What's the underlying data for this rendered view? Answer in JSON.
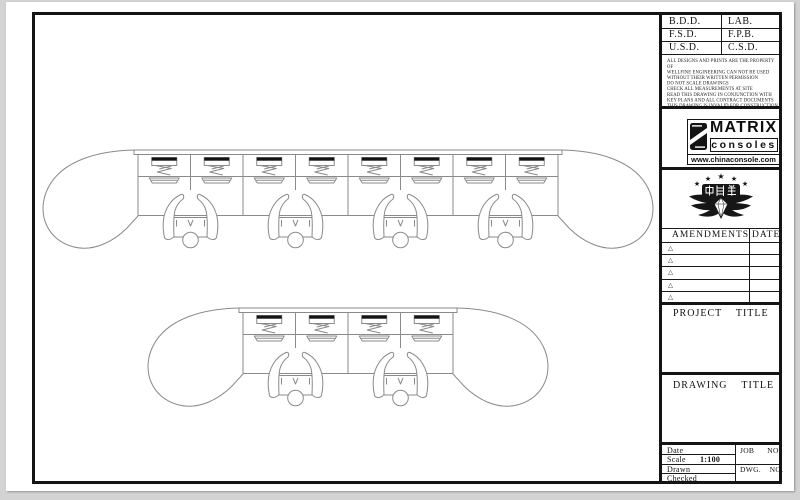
{
  "approvals": {
    "rows": [
      {
        "left": "B.D.D.",
        "right": "LAB."
      },
      {
        "left": "F.S.D.",
        "right": "F.P.B."
      },
      {
        "left": "U.S.D.",
        "right": "C.S.D."
      }
    ]
  },
  "disclaimer": {
    "lines": [
      "ALL DESIGNS AND PRINTS ARE THE PROPERTY OF",
      "WELLFINE ENGINEERING CAN NOT BE USED",
      "WITHOUT THEIR WRITTEN PERMISSION",
      "DO NOT SCALE DRAWINGS",
      "CHECK ALL MEASUREMENTS AT SITE",
      "READ THIS DRAWING IN CONJUNCTION WITH",
      "KEY PLANS AND ALL CONTRACT DOCUMENTS",
      "THIS DRAWING IS INVALID FOR CONSTRUCTION",
      "UNLESS EXPRESSLY CERTIFIED"
    ]
  },
  "brand": {
    "name": "MATRIX",
    "product": "consoles",
    "website": "www.chinaconsole.com"
  },
  "badge": {
    "text": "中創美"
  },
  "amendments": {
    "title": "AMENDMENTS",
    "date_header": "DATE",
    "row_marker": "△"
  },
  "project": {
    "label": "PROJECT    TITLE"
  },
  "drawing_title": {
    "label": "DRAWING    TITLE"
  },
  "footer": {
    "date": "Date",
    "scale": "Scale",
    "scale_value": "1:100",
    "drawn": "Drawn",
    "checked": "Checked",
    "job_no": "JOB      NO.",
    "dwg_no": "DWG.    NO."
  },
  "plan": {
    "view": "top-down console plan",
    "consoles": [
      {
        "bays": 4,
        "monitors": 8,
        "operators": 4
      },
      {
        "bays": 2,
        "monitors": 4,
        "operators": 2
      }
    ]
  },
  "colors": {
    "line": "#8a8a8a",
    "ink": "#141414",
    "paper": "#ffffff",
    "canvas": "#d3d3d3"
  }
}
